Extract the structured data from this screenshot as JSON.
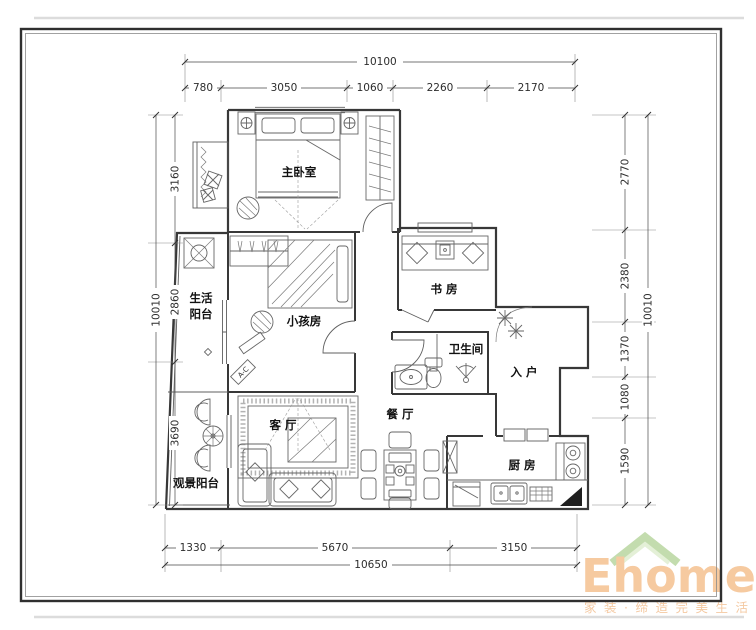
{
  "plan": {
    "rooms": {
      "master_bedroom": "主卧室",
      "kids_room": "小孩房",
      "study": "书 房",
      "bathroom": "卫生间",
      "entrance": "入 户",
      "dining": "餐 厅",
      "living": "客 厅",
      "kitchen": "厨 房",
      "life_balcony_line1": "生活",
      "life_balcony_line2": "阳台",
      "view_balcony": "观景阳台"
    },
    "annotations": {
      "ac_unit": "A-C"
    }
  },
  "dimensions": {
    "top": {
      "total": "10100",
      "segments": [
        "780",
        "3050",
        "1060",
        "2260",
        "2170"
      ]
    },
    "bottom": {
      "total": "10650",
      "segments": [
        "1330",
        "5670",
        "3150"
      ]
    },
    "left": {
      "total": "10010",
      "segments": [
        "3160",
        "2860",
        "3690"
      ]
    },
    "right": {
      "total": "10010",
      "segments": [
        "2770",
        "2380",
        "1370",
        "1080",
        "1590"
      ]
    }
  },
  "logo": {
    "brand": "Ehome8",
    "tagline": "家装·缔造完美生活",
    "brand_color": "#f6caa0",
    "roof_color": "#c3dcae"
  },
  "colors": {
    "wall": "#383838",
    "dimension": "#4a4a4a",
    "frame": "#2f2f2f"
  }
}
